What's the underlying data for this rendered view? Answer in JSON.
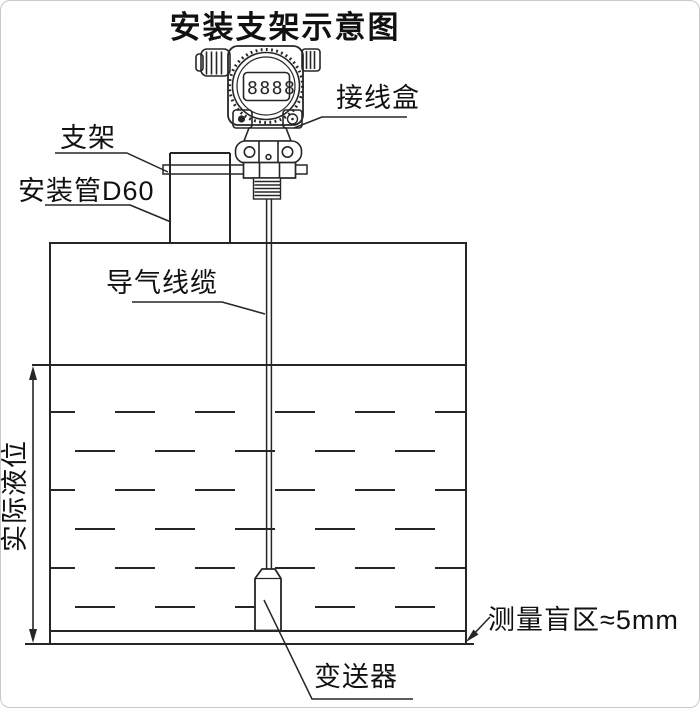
{
  "title": "安装支架示意图",
  "instrument": {
    "display": "8888"
  },
  "labels": {
    "junction_box": "接线盒",
    "bracket": "支架",
    "mounting_pipe": "安装管D60",
    "air_cable": "导气线缆",
    "actual_level": "实际液位",
    "blind_zone": "测量盲区≈5mm",
    "transmitter": "变送器"
  },
  "colors": {
    "line": "#262626",
    "text": "#111111",
    "background": "#ffffff"
  }
}
